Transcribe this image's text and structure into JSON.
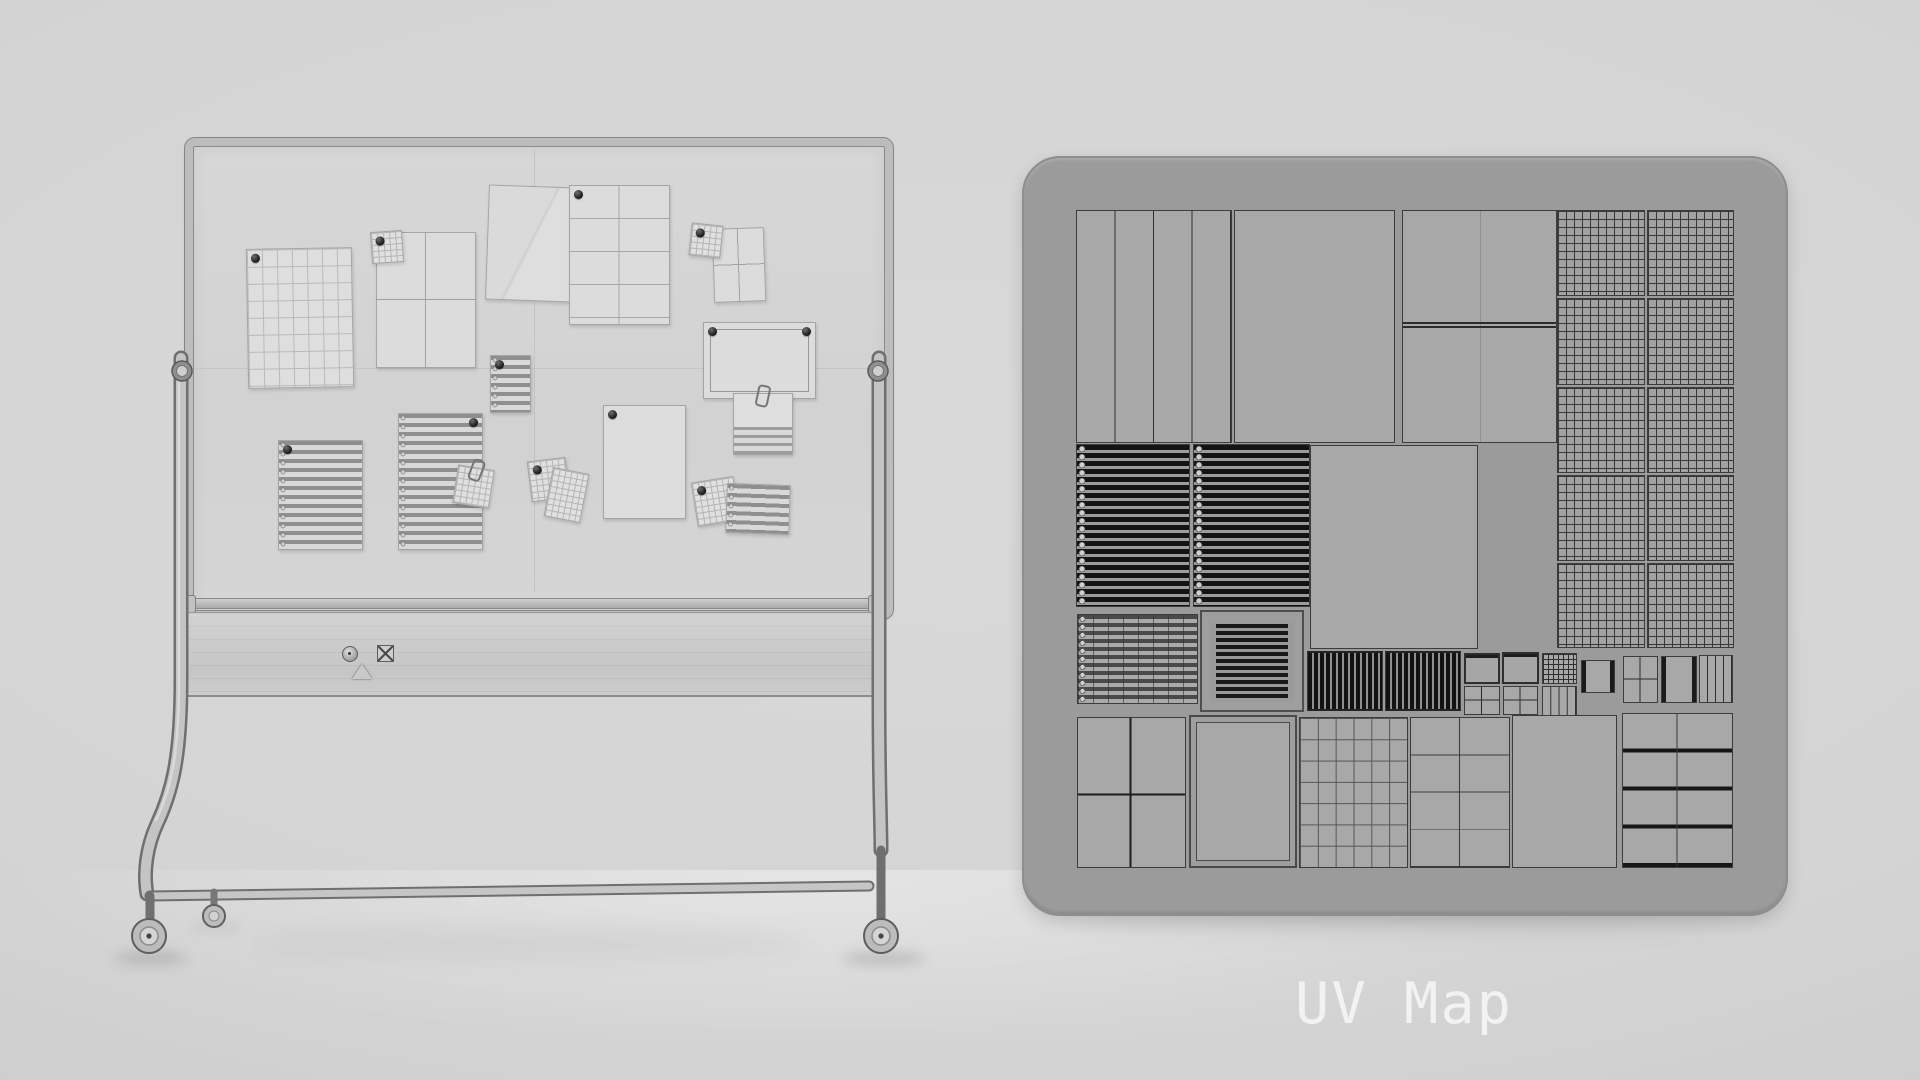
{
  "caption": {
    "label": "UV Map"
  },
  "scene": {
    "left_object": "mobile-whiteboard-wireframe-render",
    "right_object": "uv-map-layout-panel"
  },
  "colors": {
    "background": "#d6d6d6",
    "panel": "#9b9b9b",
    "island_fill": "#a8a8a8",
    "island_line": "#3c3c3c",
    "caption_text": "#f2f2f2"
  },
  "whiteboard": {
    "magnets": [
      "circle-magnet",
      "x-square-magnet",
      "triangle-magnet"
    ],
    "wheel_count": 3,
    "papers": [
      {
        "n": "grid-paper",
        "t": "p-grid",
        "x": 247,
        "y": 248,
        "w": 106,
        "h": 140,
        "rot": -1,
        "pin": "tl"
      },
      {
        "n": "quad-paper",
        "t": "p-quad",
        "x": 376,
        "y": 232,
        "w": 100,
        "h": 136,
        "rot": 0
      },
      {
        "n": "sticky-grid-note",
        "t": "p-note",
        "x": 371,
        "y": 231,
        "w": 32,
        "h": 32,
        "rot": -4,
        "pin": "tl"
      },
      {
        "n": "creased-paper",
        "t": "p-crease",
        "x": 487,
        "y": 186,
        "w": 87,
        "h": 115,
        "rot": 2
      },
      {
        "n": "table-paper",
        "t": "p-table",
        "x": 569,
        "y": 185,
        "w": 101,
        "h": 140,
        "rot": 0,
        "pin": "tl"
      },
      {
        "n": "quad-paper-small",
        "t": "p-quad",
        "x": 713,
        "y": 228,
        "w": 52,
        "h": 74,
        "rot": -2
      },
      {
        "n": "sticky-grid-note",
        "t": "p-note",
        "x": 690,
        "y": 224,
        "w": 32,
        "h": 33,
        "rot": 6,
        "pin": "tl"
      },
      {
        "n": "certificate-paper",
        "t": "p-cert",
        "x": 703,
        "y": 322,
        "w": 113,
        "h": 77,
        "rot": 0,
        "pin": "tl+tr"
      },
      {
        "n": "clipped-note",
        "t": "p-clip",
        "x": 733,
        "y": 393,
        "w": 60,
        "h": 62,
        "rot": 0,
        "clip": true
      },
      {
        "n": "plain-paper",
        "t": "p-plain",
        "x": 603,
        "y": 405,
        "w": 83,
        "h": 114,
        "rot": 0,
        "pin": "tl"
      },
      {
        "n": "ruled-paper",
        "t": "p-ruled",
        "x": 278,
        "y": 440,
        "w": 85,
        "h": 110,
        "rot": 0,
        "pin": "tl"
      },
      {
        "n": "ruled-paper",
        "t": "p-ruled",
        "x": 398,
        "y": 413,
        "w": 85,
        "h": 137,
        "rot": 0,
        "pin": "tr"
      },
      {
        "n": "ruled-note",
        "t": "p-ruled",
        "x": 490,
        "y": 355,
        "w": 41,
        "h": 58,
        "rot": 0,
        "pin": "tl"
      },
      {
        "n": "sticky-grid-note",
        "t": "p-note",
        "x": 455,
        "y": 467,
        "w": 37,
        "h": 39,
        "rot": 9,
        "clip": true
      },
      {
        "n": "sticky-grid-note",
        "t": "p-note",
        "x": 529,
        "y": 459,
        "w": 39,
        "h": 41,
        "rot": -7,
        "pin": "tl"
      },
      {
        "n": "sticky-grid-note",
        "t": "p-note",
        "x": 548,
        "y": 470,
        "w": 37,
        "h": 50,
        "rot": 11
      },
      {
        "n": "sticky-grid-note",
        "t": "p-note",
        "x": 694,
        "y": 479,
        "w": 43,
        "h": 45,
        "rot": -9,
        "pin": "tl"
      },
      {
        "n": "ruled-note",
        "t": "p-ruled",
        "x": 726,
        "y": 484,
        "w": 64,
        "h": 50,
        "rot": 2
      }
    ]
  },
  "uv_map": {
    "islands": [
      {
        "t": "i-cols4",
        "x": 1076,
        "y": 210,
        "w": 156,
        "h": 233
      },
      {
        "t": "i-plain",
        "x": 1234,
        "y": 210,
        "w": 161,
        "h": 233
      },
      {
        "t": "i-splith",
        "x": 1402,
        "y": 210,
        "w": 155,
        "h": 233
      },
      {
        "t": "i-grid",
        "x": 1557,
        "y": 210,
        "w": 88,
        "h": 86
      },
      {
        "t": "i-grid",
        "x": 1647,
        "y": 210,
        "w": 87,
        "h": 86
      },
      {
        "t": "i-grid",
        "x": 1557,
        "y": 298,
        "w": 88,
        "h": 87
      },
      {
        "t": "i-grid",
        "x": 1647,
        "y": 298,
        "w": 87,
        "h": 87
      },
      {
        "t": "i-grid",
        "x": 1557,
        "y": 387,
        "w": 88,
        "h": 86
      },
      {
        "t": "i-grid",
        "x": 1647,
        "y": 387,
        "w": 87,
        "h": 86
      },
      {
        "t": "i-grid",
        "x": 1557,
        "y": 475,
        "w": 88,
        "h": 86
      },
      {
        "t": "i-grid",
        "x": 1647,
        "y": 475,
        "w": 87,
        "h": 86
      },
      {
        "t": "i-grid",
        "x": 1557,
        "y": 563,
        "w": 88,
        "h": 85
      },
      {
        "t": "i-grid",
        "x": 1647,
        "y": 563,
        "w": 87,
        "h": 85
      },
      {
        "t": "i-hstripes",
        "x": 1076,
        "y": 444,
        "w": 114,
        "h": 163
      },
      {
        "t": "i-hstripes",
        "x": 1193,
        "y": 444,
        "w": 117,
        "h": 163
      },
      {
        "t": "i-plain",
        "x": 1310,
        "y": 445,
        "w": 168,
        "h": 204
      },
      {
        "t": "i-hsgrid",
        "x": 1077,
        "y": 614,
        "w": 121,
        "h": 90
      },
      {
        "t": "i-frstripes",
        "x": 1200,
        "y": 610,
        "w": 104,
        "h": 102
      },
      {
        "t": "i-vbars",
        "x": 1307,
        "y": 651,
        "w": 76,
        "h": 60
      },
      {
        "t": "i-vbars",
        "x": 1385,
        "y": 651,
        "w": 76,
        "h": 60
      },
      {
        "t": "i-miniframe",
        "x": 1464,
        "y": 653,
        "w": 36,
        "h": 31
      },
      {
        "t": "i-minicross",
        "x": 1464,
        "y": 686,
        "w": 36,
        "h": 29
      },
      {
        "t": "i-miniframe",
        "x": 1502,
        "y": 652,
        "w": 37,
        "h": 32
      },
      {
        "t": "i-minicross",
        "x": 1503,
        "y": 686,
        "w": 35,
        "h": 29
      },
      {
        "t": "i-minigrid",
        "x": 1542,
        "y": 653,
        "w": 35,
        "h": 31
      },
      {
        "t": "i-minicols",
        "x": 1542,
        "y": 686,
        "w": 35,
        "h": 30
      },
      {
        "t": "i-miniside",
        "x": 1581,
        "y": 660,
        "w": 34,
        "h": 33
      },
      {
        "t": "i-minicross",
        "x": 1623,
        "y": 656,
        "w": 35,
        "h": 47
      },
      {
        "t": "i-miniside",
        "x": 1661,
        "y": 656,
        "w": 36,
        "h": 47
      },
      {
        "t": "i-minicols",
        "x": 1699,
        "y": 655,
        "w": 34,
        "h": 48
      },
      {
        "t": "i-cross2x2",
        "x": 1077,
        "y": 717,
        "w": 109,
        "h": 151
      },
      {
        "t": "i-framed",
        "x": 1189,
        "y": 715,
        "w": 108,
        "h": 153
      },
      {
        "t": "i-grid6",
        "x": 1299,
        "y": 717,
        "w": 109,
        "h": 151
      },
      {
        "t": "i-rows4",
        "x": 1410,
        "y": 717,
        "w": 100,
        "h": 151
      },
      {
        "t": "i-plain",
        "x": 1512,
        "y": 715,
        "w": 105,
        "h": 153
      },
      {
        "t": "i-rows4d",
        "x": 1622,
        "y": 713,
        "w": 111,
        "h": 155
      }
    ]
  }
}
